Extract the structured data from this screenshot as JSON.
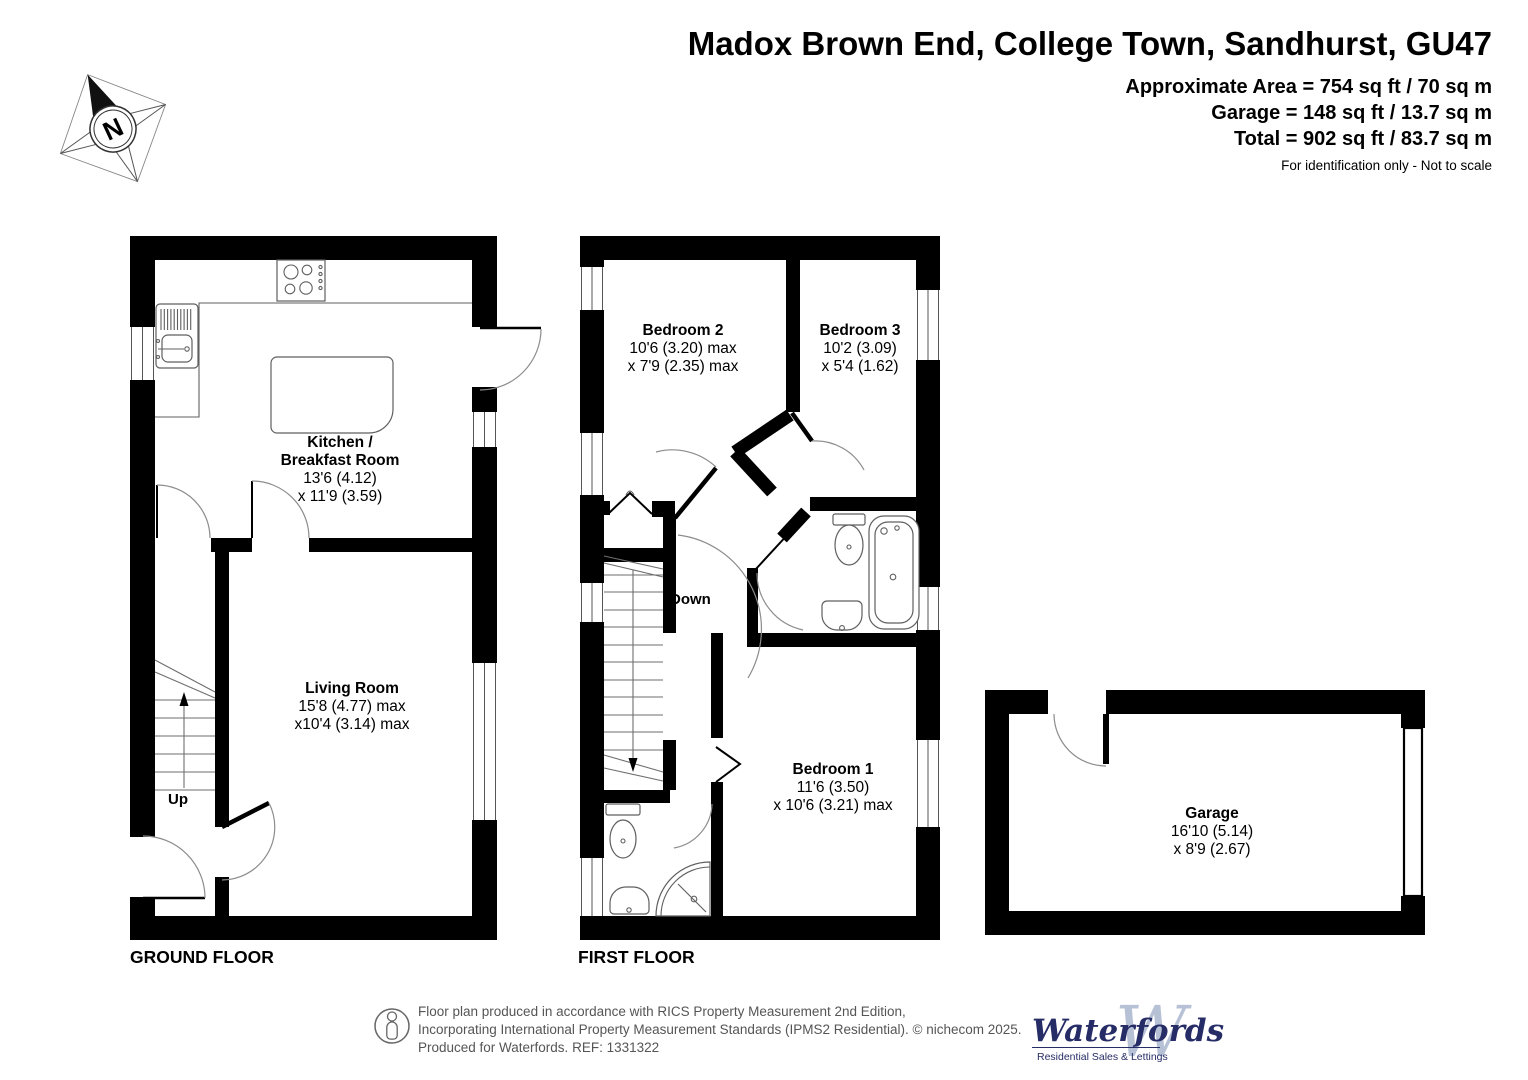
{
  "header": {
    "title": "Madox Brown End, College Town, Sandhurst, GU47",
    "area_lines": [
      "Approximate Area = 754 sq ft / 70 sq m",
      "Garage = 148 sq ft / 13.7 sq m",
      "Total = 902 sq ft / 83.7 sq m"
    ],
    "disclaimer": "For identification only - Not to scale"
  },
  "compass": {
    "north_label": "N"
  },
  "ground_floor": {
    "label": "GROUND FLOOR",
    "stairs_label": "Up",
    "kitchen": {
      "name_line1": "Kitchen /",
      "name_line2": "Breakfast Room",
      "dims_line1": "13'6 (4.12)",
      "dims_line2": "x 11'9 (3.59)"
    },
    "living_room": {
      "name": "Living Room",
      "dims_line1": "15'8 (4.77) max",
      "dims_line2": "x10'4 (3.14) max"
    }
  },
  "first_floor": {
    "label": "FIRST FLOOR",
    "stairs_label": "Down",
    "bedroom1": {
      "name": "Bedroom 1",
      "dims_line1": "11'6 (3.50)",
      "dims_line2": "x 10'6 (3.21) max"
    },
    "bedroom2": {
      "name": "Bedroom 2",
      "dims_line1": "10'6 (3.20) max",
      "dims_line2": "x 7'9 (2.35) max"
    },
    "bedroom3": {
      "name": "Bedroom 3",
      "dims_line1": "10'2 (3.09)",
      "dims_line2": "x 5'4 (1.62)"
    }
  },
  "garage": {
    "name": "Garage",
    "dims_line1": "16'10 (5.14)",
    "dims_line2": "x 8'9 (2.67)"
  },
  "footer": {
    "line1": "Floor plan produced in accordance with RICS Property Measurement 2nd Edition,",
    "line2": "Incorporating International Property Measurement Standards (IPMS2 Residential).   © nichecom 2025.",
    "line3": "Produced for Waterfords.   REF: 1331322",
    "logo": {
      "name": "Waterfords",
      "monogram": "W",
      "tagline": "Residential Sales & Lettings"
    }
  },
  "colors": {
    "wall": "#000000",
    "thin_line": "#6e6e6e",
    "logo_navy": "#262c66",
    "logo_light": "#b7c1d6",
    "footer_text": "#555555"
  }
}
